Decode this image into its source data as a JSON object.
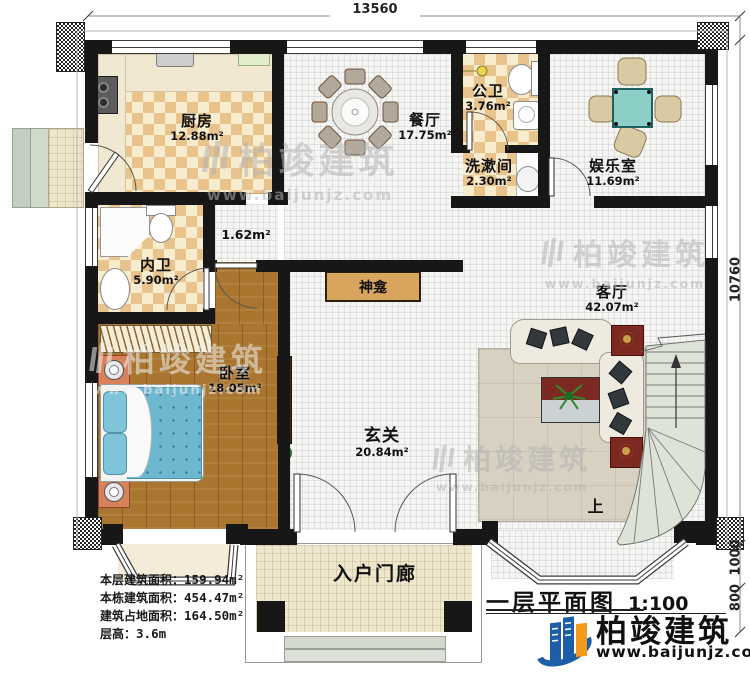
{
  "dimensions": {
    "top_width": "13560",
    "right_height": "10760",
    "right_porch": "1000",
    "right_steps": "800"
  },
  "rooms": {
    "kitchen": {
      "name": "厨房",
      "area": "12.88m²"
    },
    "dining": {
      "name": "餐厅",
      "area": "17.75m²"
    },
    "public_bath": {
      "name": "公卫",
      "area": "3.76m²"
    },
    "laundry": {
      "name": "洗漱间",
      "area": "2.30m²"
    },
    "entertainment": {
      "name": "娱乐室",
      "area": "11.69m²"
    },
    "inner_bath": {
      "name": "内卫",
      "area": "5.90m²"
    },
    "corridor": {
      "area": "1.62m²"
    },
    "bedroom": {
      "name": "卧室",
      "area": "18.05m²"
    },
    "foyer": {
      "name": "玄关",
      "area": "20.84m²"
    },
    "living": {
      "name": "客厅",
      "area": "42.07m²"
    },
    "shrine": {
      "name": "神龛"
    },
    "porch": {
      "name": "入户门廊"
    },
    "stairs": {
      "up_label": "上"
    }
  },
  "stats": {
    "rows": [
      {
        "label": "本层建筑面积：",
        "value": "159.94m²"
      },
      {
        "label": "本栋建筑面积：",
        "value": "454.47m²"
      },
      {
        "label": "建筑占地面积：",
        "value": "164.50m²"
      },
      {
        "label": "层高：",
        "value": "3.6m"
      }
    ]
  },
  "title": {
    "name": "一层平面图",
    "scale": "1:100"
  },
  "brand": {
    "name": "柏竣建筑",
    "website": "www.baijunjz.com"
  },
  "watermark": {
    "name": "柏竣建筑",
    "website": "www.baijunjz.com"
  },
  "colors": {
    "wall": "#171717",
    "checker_tan": "#e8c48c",
    "wood": "#a9752f",
    "bed_teal": "#6db8cf",
    "table_teal": "#8ccfc6",
    "cabinet_red": "#7c2a21",
    "stairs_green": "#dde4d7",
    "logo_blue": "#1c5fa8",
    "logo_orange": "#f29a1d"
  }
}
